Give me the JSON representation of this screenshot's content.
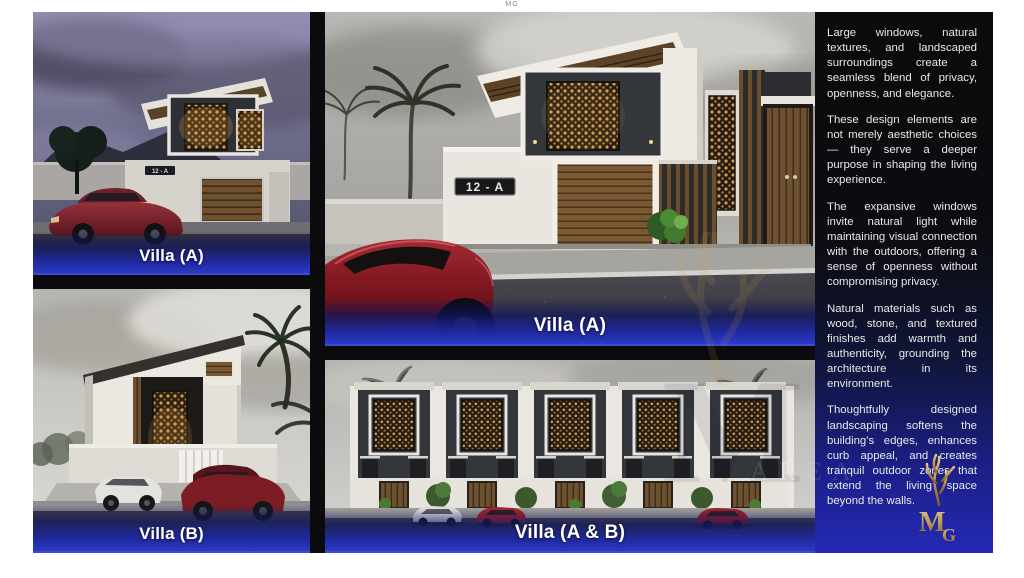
{
  "page": {
    "top_mark": "MG"
  },
  "panels": {
    "villa_a_small": {
      "label": "Villa (A)",
      "address_plaque": "12 - A"
    },
    "villa_a_large": {
      "label": "Villa (A)",
      "address_plaque": "12 - A"
    },
    "villa_b": {
      "label": "Villa (B)"
    },
    "villa_ab": {
      "label": "Villa (A & B)"
    }
  },
  "sidebar": {
    "paragraphs": [
      "Large windows, natural textures, and landscaped surroundings create a seamless blend of privacy, openness, and elegance.",
      "These design elements are not merely aesthetic choices — they serve a deeper purpose in shaping the living experience.",
      "The expansive windows invite natural light while maintaining visual connection with the outdoors, offering a sense of openness without compromising privacy.",
      "Natural materials such as wood, stone, and textured finishes add warmth and authenticity, grounding the architecture in its environment.",
      "Thoughtfully designed landscaping softens the building's edges, enhances curb appeal, and creates tranquil outdoor zones that extend the living space beyond the walls."
    ]
  },
  "branding": {
    "logo_monogram_m": "M",
    "logo_monogram_g": "G",
    "watermark_text": "AREA"
  },
  "colors": {
    "label_bar_blue": "#2b3ac6",
    "deep_blue": "#2329b4",
    "gold": "#c9a14f"
  }
}
